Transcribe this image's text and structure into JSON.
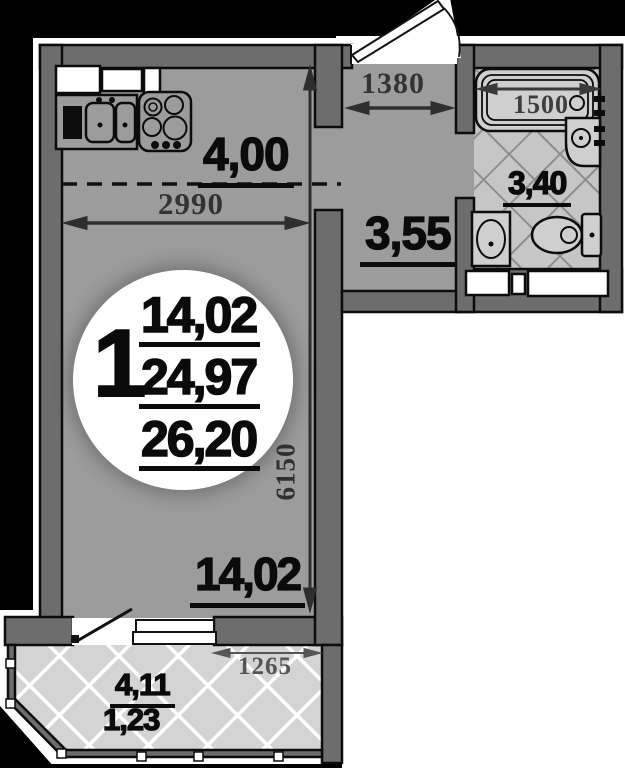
{
  "plan": {
    "circle_badge": {
      "unit": "1",
      "living_area": "14,02",
      "total_area": "24,97",
      "total_with_balcony": "26,20"
    },
    "areas": {
      "kitchen_zone": "4,00",
      "hallway": "3,55",
      "bathroom": "3,40",
      "room": "14,02",
      "balcony": "4,11",
      "balcony_coeff": "1,23"
    },
    "dimensions_mm": {
      "kitchen_width": "2990",
      "hallway_width": "1380",
      "bathtub_length": "1500",
      "room_depth": "6150",
      "balcony_width": "1265"
    },
    "colors": {
      "background": "#000000",
      "wall": "#6d6d6d",
      "floor": "#9c9c9c",
      "tile": "#c6c6c6",
      "balcony_tile": "#d4d4d4"
    }
  }
}
